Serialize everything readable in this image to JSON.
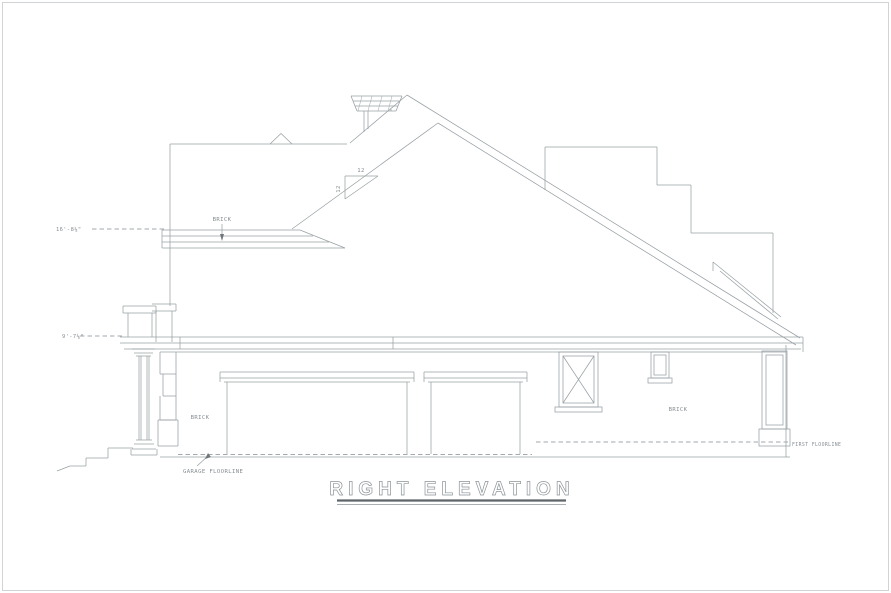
{
  "drawing": {
    "title": "RIGHT ELEVATION",
    "labels": {
      "brick_upper": "BRICK",
      "brick_left": "BRICK",
      "brick_right": "BRICK",
      "garage_floorline": "GARAGE FLOORLINE",
      "first_floorline": "FIRST FLOORLINE"
    },
    "dimensions": {
      "upper_left_height": "16'-8⅛\"",
      "lower_left_height": "9'-7⅛\""
    },
    "roof_pitch": {
      "run": "12",
      "rise": "12"
    },
    "colors": {
      "background": "#ffffff",
      "line": "#98a0a5",
      "text": "#868d92",
      "underline": "#5f666b"
    }
  }
}
